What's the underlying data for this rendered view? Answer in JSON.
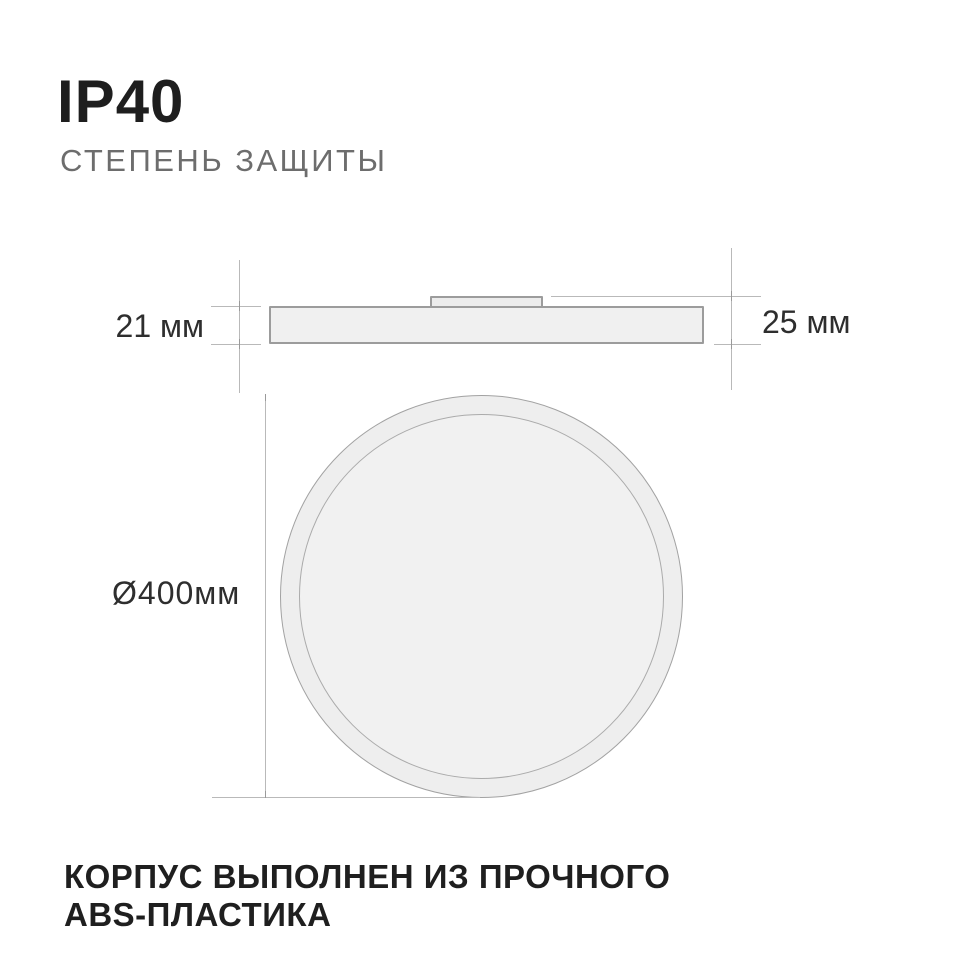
{
  "header": {
    "title": "IP40",
    "subtitle": "СТЕПЕНЬ ЗАЩИТЫ"
  },
  "diagram": {
    "side_view": {
      "panel_height_label": "21 мм",
      "total_height_label": "25 мм"
    },
    "top_view": {
      "diameter_label": "Ø400мм"
    }
  },
  "footer": {
    "line1": "КОРПУС ВЫПОЛНЕН ИЗ ПРОЧНОГО",
    "line2": "ABS-ПЛАСТИКА"
  },
  "colors": {
    "background": "#ffffff",
    "text_primary": "#1e1e1e",
    "text_secondary": "#6d6d6d",
    "dimension_text": "#2e2e2e",
    "shape_fill": "#efefef",
    "shape_stroke": "#9c9c9c",
    "dimension_line": "#b9b9b9"
  }
}
